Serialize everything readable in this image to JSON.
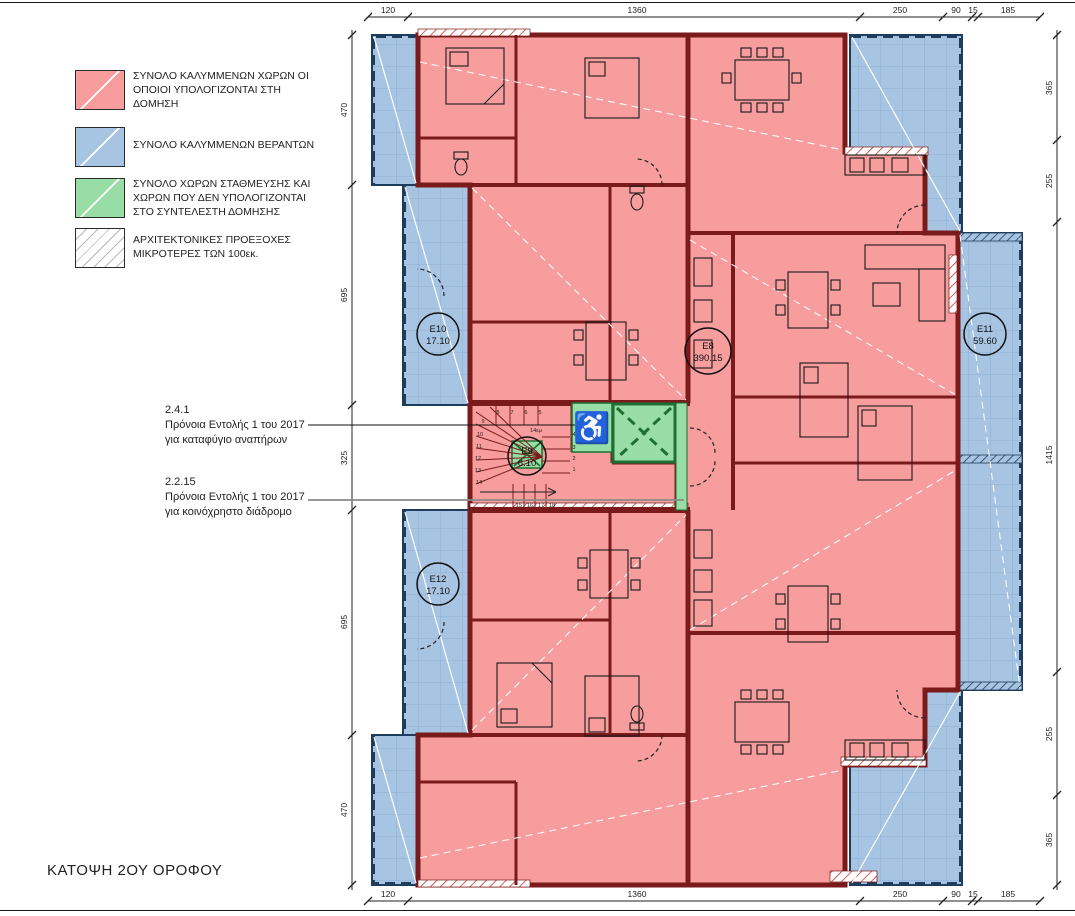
{
  "title": "ΚΑΤΟΨΗ 2ΟΥ ΟΡΟΦΟΥ",
  "legend": {
    "items": [
      {
        "label": "ΣΥΝΟΛΟ ΚΑΛΥΜΜΕΝΩΝ ΧΩΡΩΝ ΟΙ ΟΠΟΙΟΙ ΥΠΟΛΟΓΙΖΟΝΤΑΙ ΣΤΗ ΔΟΜΗΣΗ",
        "color": "#f79d9d",
        "style": "solid"
      },
      {
        "label": "ΣΥΝΟΛΟ ΚΑΛΥΜΜΕΝΩΝ ΒΕΡΑΝΤΩΝ",
        "color": "#a7c4e2",
        "style": "solid"
      },
      {
        "label": "ΣΥΝΟΛΟ ΧΩΡΩΝ ΣΤΑΘΜΕΥΣΗΣ ΚΑΙ ΧΩΡΩΝ ΠΟΥ ΔΕΝ ΥΠΟΛΟΓΙΖΟΝΤΑΙ ΣΤΟ ΣΥΝΤΕΛΕΣΤΗ ΔΟΜΗΣΗΣ",
        "color": "#98dca6",
        "style": "solid"
      },
      {
        "label": "ΑΡΧΙΤΕΚΤΟΝΙΚΕΣ ΠΡΟΕΞΟΧΕΣ ΜΙΚΡΟΤΕΡΕΣ ΤΩΝ 100εκ.",
        "color": "#ffffff",
        "style": "hatched"
      }
    ]
  },
  "annotations": [
    {
      "code": "2.4.1",
      "line1": "Πρόνοια Εντολής 1 του 2017",
      "line2": "για καταφύγιο αναπήρων"
    },
    {
      "code": "2.2.15",
      "line1": "Πρόνοια Εντολής 1 του 2017",
      "line2": "για κοινόχρηστο διάδρομο"
    }
  ],
  "dimensions": {
    "top": [
      "120",
      "1360",
      "250",
      "90",
      "15",
      "185"
    ],
    "bottom": [
      "120",
      "1360",
      "250",
      "90",
      "15",
      "185"
    ],
    "left": [
      "470",
      "695",
      "325",
      "695",
      "470"
    ],
    "right": [
      "365",
      "255",
      "1415",
      "255",
      "365"
    ]
  },
  "areas": [
    {
      "id": "E10",
      "value": "17.10"
    },
    {
      "id": "E8",
      "value": "390.15"
    },
    {
      "id": "E11",
      "value": "59.60"
    },
    {
      "id": "E12",
      "value": "17.10"
    },
    {
      "id": "E9",
      "value": "6.10"
    }
  ],
  "stair": {
    "note": "14εμ",
    "treads": [
      "1",
      "2",
      "3",
      "4",
      "5",
      "6",
      "7",
      "8",
      "9",
      "10",
      "11",
      "12",
      "13",
      "14",
      "15",
      "16",
      "17",
      "18"
    ]
  },
  "colors": {
    "covered_area_pink": "#f79d9d",
    "wall_red": "#7a1a1a",
    "veranda_blue": "#a7c4e2",
    "veranda_grid": "#8fb0d4",
    "railing_navy": "#1e3c5c",
    "non_countable_green": "#98dca6",
    "green_dark": "#1e6f32",
    "hatch_red": "#c0392b",
    "leader_gray": "#8a8a8a"
  }
}
